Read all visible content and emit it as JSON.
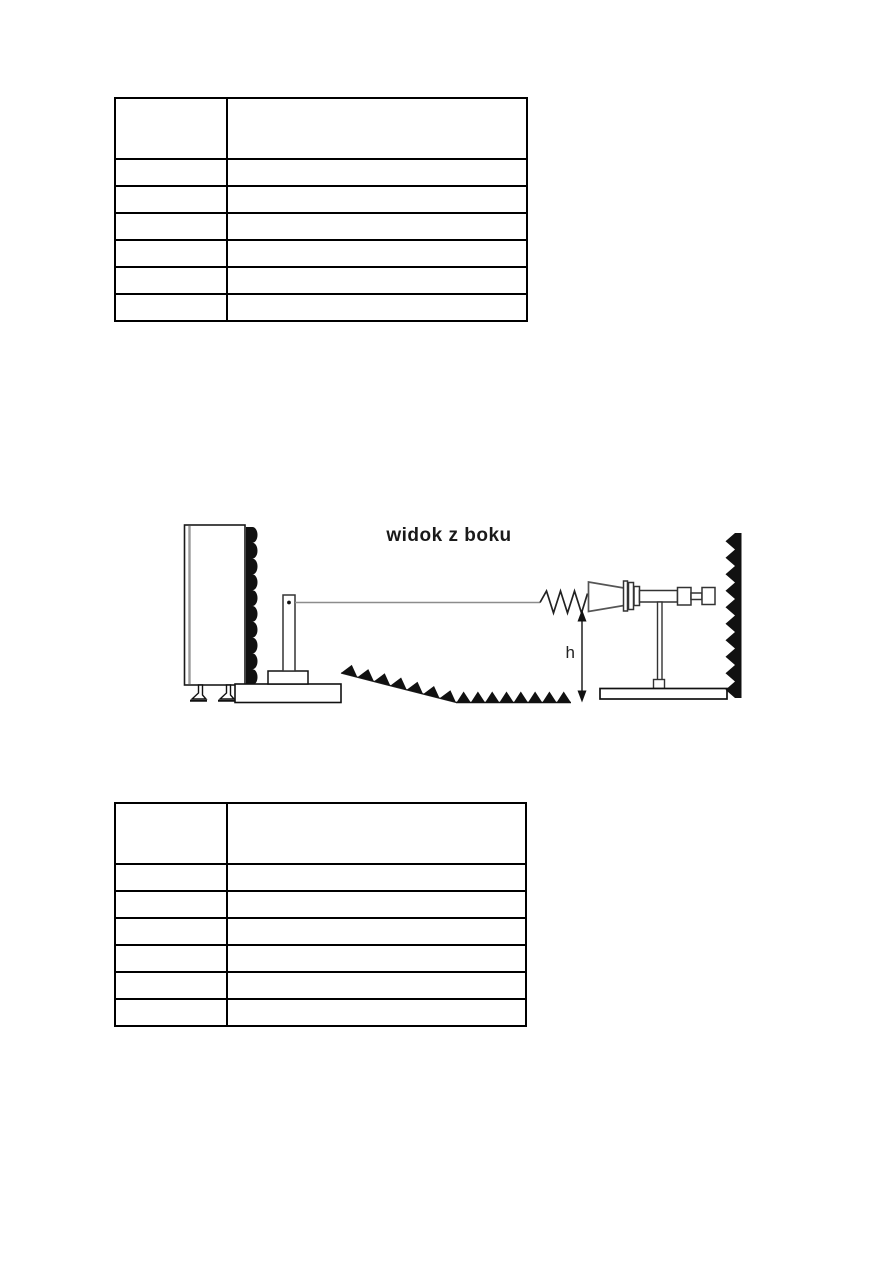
{
  "document": {
    "background_color": "#ffffff",
    "ink_color": "#111111",
    "line_gray_color": "#8c8c8c"
  },
  "tables": [
    {
      "name": "top-measurement-table",
      "columns": 2,
      "header": [
        "",
        ""
      ],
      "rows": [
        [
          "",
          ""
        ],
        [
          "",
          ""
        ],
        [
          "",
          ""
        ],
        [
          "",
          ""
        ],
        [
          "",
          ""
        ],
        [
          "",
          ""
        ]
      ]
    },
    {
      "name": "bottom-measurement-table",
      "columns": 2,
      "header": [
        "",
        ""
      ],
      "rows": [
        [
          "",
          ""
        ],
        [
          "",
          ""
        ],
        [
          "",
          ""
        ],
        [
          "",
          ""
        ],
        [
          "",
          ""
        ],
        [
          "",
          ""
        ]
      ]
    }
  ],
  "diagram": {
    "title": "widok z boku",
    "height_label": "h"
  }
}
